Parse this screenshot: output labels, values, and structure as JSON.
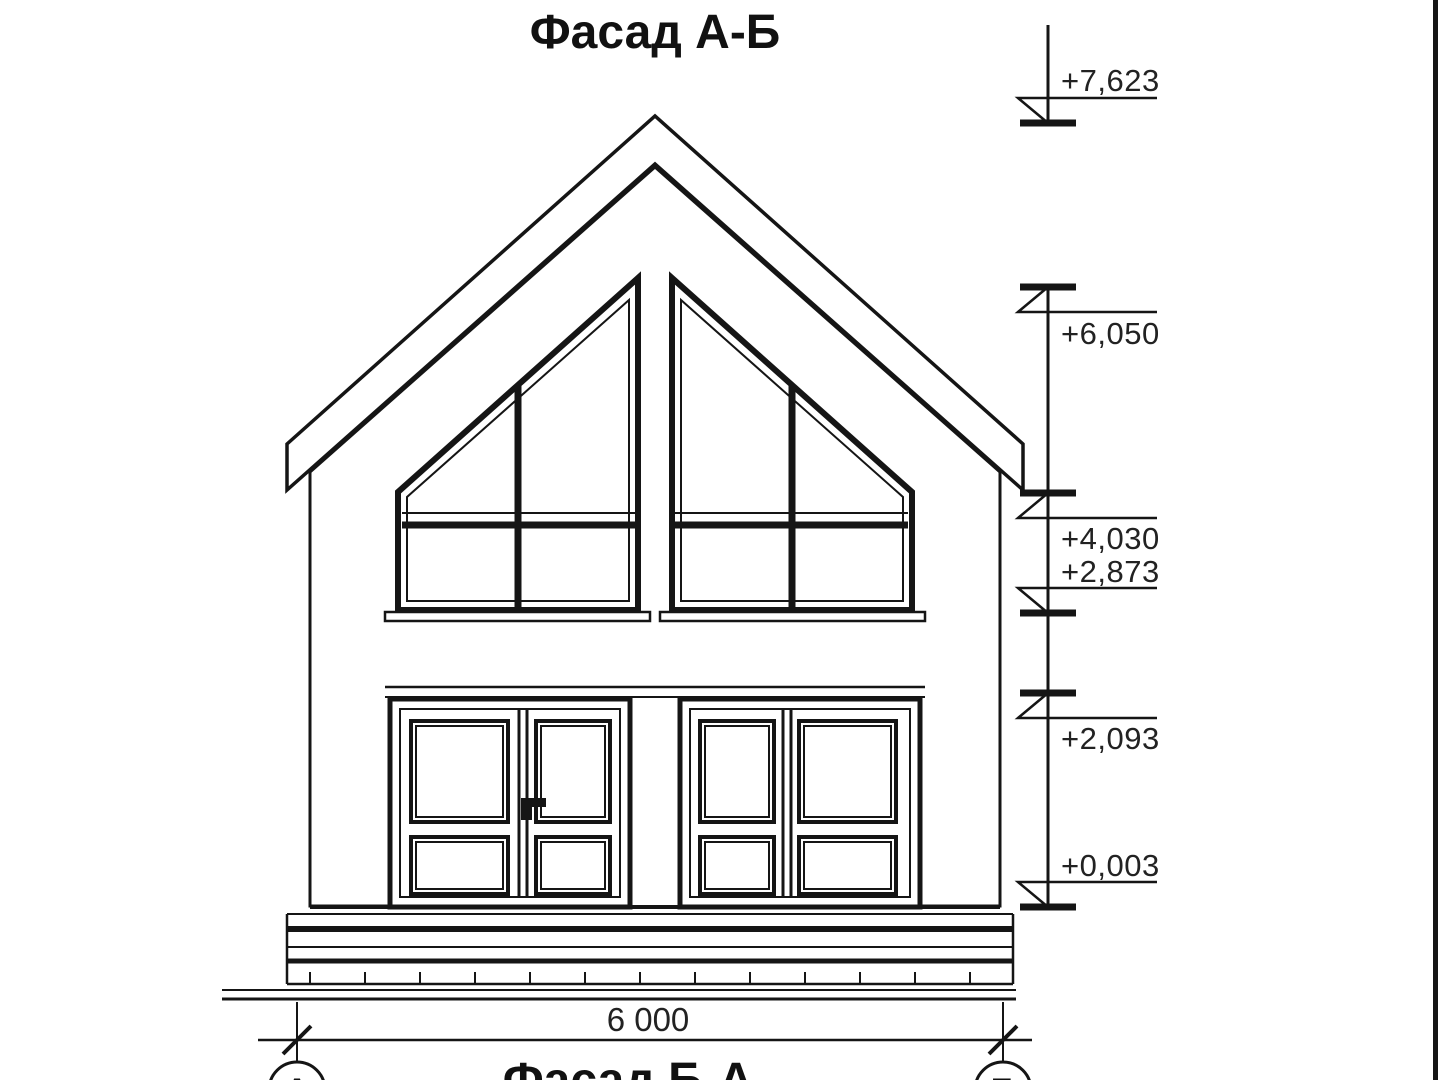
{
  "title": "Фасад А-Б",
  "footer_title": "Фасад Б-А",
  "dimension": {
    "value": "6 000"
  },
  "axis_markers": [
    {
      "label": "А"
    },
    {
      "label": "Б"
    }
  ],
  "elevation_marks": [
    {
      "value": "+7,623"
    },
    {
      "value": "+6,050"
    },
    {
      "value": "+4,030"
    },
    {
      "value": "+2,873"
    },
    {
      "value": "+2,093"
    },
    {
      "value": "+0,003"
    }
  ],
  "colors": {
    "line": "#151515",
    "background": "#ffffff",
    "text": "#222222"
  }
}
